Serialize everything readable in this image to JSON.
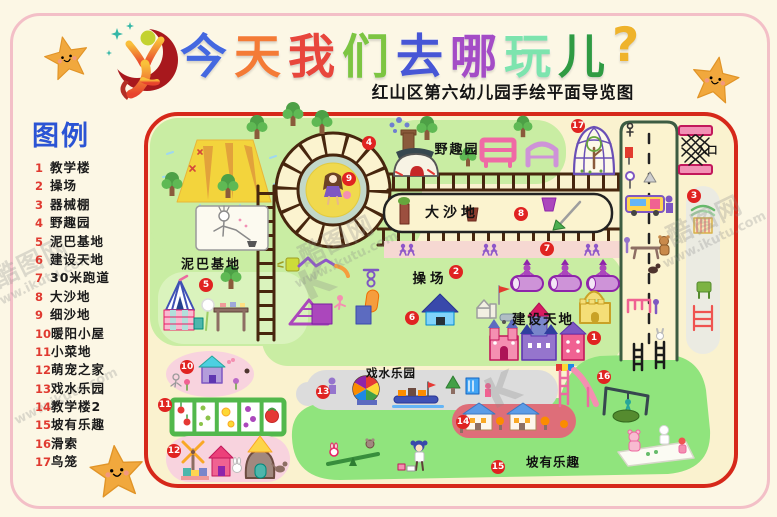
{
  "title": {
    "chars": [
      {
        "ch": "今",
        "css": "color:#4468e0"
      },
      {
        "ch": "天",
        "css": "color:#f47b36"
      },
      {
        "ch": "我",
        "css": "color:#e8463c"
      },
      {
        "ch": "们",
        "css": "color:#7dc542"
      },
      {
        "ch": "去",
        "css": "color:#4756d6"
      },
      {
        "ch": "哪",
        "css": "color:#a44cc6"
      },
      {
        "ch": "玩",
        "css": "color:#7de4ae"
      },
      {
        "ch": "儿",
        "css": "color:#2f9b43"
      },
      {
        "ch": "?",
        "css": "color:#efb32b"
      }
    ],
    "subtitle": "红山区第六幼儿园手绘平面导览图"
  },
  "legend": {
    "title": "图例",
    "items": [
      {
        "num": "1",
        "label": "教学楼"
      },
      {
        "num": "2",
        "label": "操场"
      },
      {
        "num": "3",
        "label": "器械棚"
      },
      {
        "num": "4",
        "label": "野趣园"
      },
      {
        "num": "5",
        "label": "泥巴基地"
      },
      {
        "num": "6",
        "label": "建设天地"
      },
      {
        "num": "7",
        "label": "30米跑道"
      },
      {
        "num": "8",
        "label": "大沙地"
      },
      {
        "num": "9",
        "label": "细沙地"
      },
      {
        "num": "10",
        "label": "暖阳小屋"
      },
      {
        "num": "11",
        "label": "小菜地"
      },
      {
        "num": "12",
        "label": "萌宠之家"
      },
      {
        "num": "13",
        "label": "戏水乐园"
      },
      {
        "num": "14",
        "label": "教学楼2"
      },
      {
        "num": "15",
        "label": "坡有乐趣"
      },
      {
        "num": "16",
        "label": "滑索"
      },
      {
        "num": "17",
        "label": "鸟笼"
      }
    ]
  },
  "map": {
    "labels": {
      "wild_garden": "野趣园",
      "big_sand": "大沙地",
      "mud_base": "泥巴基地",
      "playground": "操场",
      "construction": "建设天地",
      "water_park": "戏水乐园",
      "slope_fun": "坡有乐趣",
      "entrance": "入口"
    },
    "badges": [
      {
        "num": "1"
      },
      {
        "num": "2"
      },
      {
        "num": "3"
      },
      {
        "num": "4"
      },
      {
        "num": "5"
      },
      {
        "num": "6"
      },
      {
        "num": "7"
      },
      {
        "num": "8"
      },
      {
        "num": "9"
      },
      {
        "num": "10"
      },
      {
        "num": "11"
      },
      {
        "num": "12"
      },
      {
        "num": "13"
      },
      {
        "num": "14"
      },
      {
        "num": "15"
      },
      {
        "num": "16"
      },
      {
        "num": "17"
      }
    ]
  },
  "watermark": {
    "site": "酷图网",
    "url": "www.ikutu.com",
    "k": "K"
  },
  "colors": {
    "page_bg": "#fcf7e5",
    "page_border": "#f3bfc7",
    "map_bg": "#faf2cf",
    "map_border": "#d6281a",
    "lawn": "#c9eda3",
    "slope": "#90e47d",
    "badge": "#e02321",
    "legend_title": "#2b54d4",
    "legend_number": "#e03a30",
    "track_brown": "#47260e",
    "run_track_pink": "#f6d8d2"
  }
}
